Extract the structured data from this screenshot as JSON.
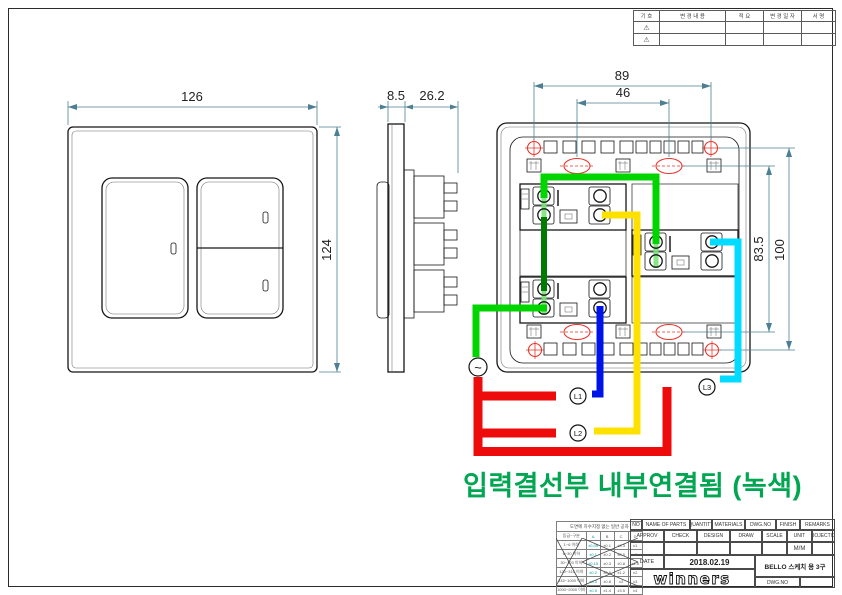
{
  "colors": {
    "wire-green": "#00d500",
    "wire-dark-green": "#007a00",
    "wire-yellow": "#ffe100",
    "wire-blue": "#0013e6",
    "wire-cyan": "#00dcff",
    "wire-red": "#ed0b0b",
    "terminal-green": "#7be37b",
    "note-green": "#00a651",
    "dim-line": "#4d7f92",
    "accent-red": "#e8342a"
  },
  "revision_table": {
    "headers": [
      "기 호",
      "변 경 내 용",
      "적 요",
      "변 경 일 자",
      "서 명"
    ],
    "rows": [
      {
        "symbol": "⚠"
      },
      {
        "symbol": "⚠"
      }
    ]
  },
  "views": {
    "front": {
      "width": "126",
      "height": "124"
    },
    "side": {
      "thickness": "8.5",
      "depth": "26.2"
    },
    "rear": {
      "mount_width": "89",
      "slot_width": "46",
      "slot_height": "83.5",
      "mount_height": "100",
      "terminals": {
        "ac": "~",
        "l1": "L1",
        "l2": "L2",
        "l3": "L3"
      }
    }
  },
  "note": {
    "text": "입력결선부 내부연결됨 (녹색)"
  },
  "tolerance_table": {
    "title": "도면에 치수지정 없는 일반 공차",
    "headers": [
      "등급~구분",
      "A",
      "B",
      "C",
      "D"
    ],
    "rows": [
      [
        "1~6 이하",
        "±0.05",
        "±0.1",
        "±0.3",
        "±1"
      ],
      [
        "6~30 이하",
        "±0.1",
        "±0.2",
        "±0.5",
        "±1"
      ],
      [
        "30~120 이하",
        "±0.15",
        "±0.3",
        "±0.8",
        "±1.5"
      ],
      [
        "120~315 이하",
        "±0.2",
        "±0.5",
        "±1.2",
        "±2"
      ],
      [
        "315~1000 이하",
        "±0.3",
        "±0.8",
        "±2",
        "±3"
      ],
      [
        "1000~2000 이하",
        "±0.5",
        "±1.4",
        "±3.5",
        "±4"
      ]
    ]
  },
  "title_block": {
    "row1": [
      "NO",
      "NAME OF PARTS",
      "QUANTITY",
      "MATERIALS",
      "DWG.NO",
      "FINISH",
      "REMARKS"
    ],
    "row2": [
      "APPROV",
      "CHECK",
      "DESIGN",
      "DRAW",
      "SCALE",
      "UNIT",
      "PROJECTION"
    ],
    "unit_value": "M/M",
    "date_label": "DATE",
    "date_value": "2018.02.19",
    "logo": "winners",
    "product": "BELLO 스케치 용 3구",
    "dwg_no_label": "DWG.NO"
  }
}
